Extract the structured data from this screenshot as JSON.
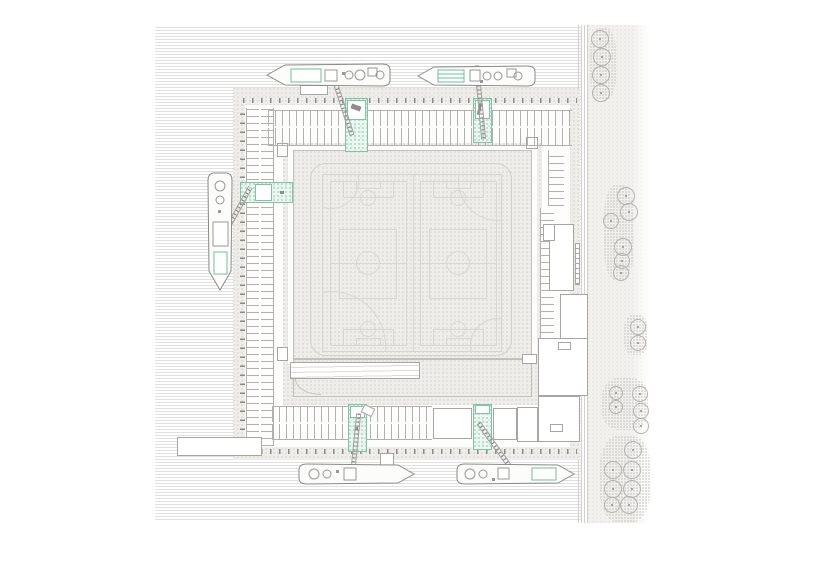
{
  "canvas": {
    "w": 818,
    "h": 578,
    "background": "#ffffff"
  },
  "colors": {
    "water_line": "#e0e0e0",
    "paving_dot": "#d7d5d1",
    "green_accent": "#7fc4a4",
    "green_fill": "#edf6f1",
    "boat_outline": "#8a8a8a",
    "building_outline": "#a8a6a2",
    "field_line": "#d9d7d3",
    "bollard": "#8c8a86"
  },
  "scene": {
    "water": {
      "x": 155,
      "y": 27,
      "w": 427,
      "h": 494
    },
    "right_strip": {
      "deck": {
        "x": 578,
        "y": 25,
        "w": 10,
        "h": 498
      },
      "ground": {
        "x": 588,
        "y": 25,
        "w": 62,
        "h": 498
      },
      "patches": [
        {
          "x": 590,
          "y": 28,
          "w": 26,
          "h": 72
        },
        {
          "x": 604,
          "y": 185,
          "w": 30,
          "h": 95
        },
        {
          "x": 624,
          "y": 315,
          "w": 24,
          "h": 40
        },
        {
          "x": 602,
          "y": 378,
          "w": 46,
          "h": 52
        },
        {
          "x": 600,
          "y": 436,
          "w": 50,
          "h": 86
        }
      ]
    },
    "trees": [
      [
        600,
        39,
        9
      ],
      [
        602,
        57,
        9
      ],
      [
        601,
        75,
        9
      ],
      [
        601,
        93,
        9
      ],
      [
        626,
        196,
        9
      ],
      [
        629,
        212,
        9
      ],
      [
        611,
        221,
        8
      ],
      [
        623,
        247,
        9
      ],
      [
        622,
        261,
        8
      ],
      [
        621,
        273,
        8
      ],
      [
        638,
        327,
        8
      ],
      [
        638,
        343,
        8
      ],
      [
        616,
        393,
        7
      ],
      [
        640,
        394,
        8
      ],
      [
        616,
        407,
        7
      ],
      [
        641,
        411,
        8
      ],
      [
        641,
        426,
        8
      ],
      [
        633,
        450,
        9
      ],
      [
        613,
        470,
        9
      ],
      [
        632,
        470,
        9
      ],
      [
        613,
        489,
        9
      ],
      [
        632,
        489,
        9
      ],
      [
        612,
        505,
        8
      ],
      [
        629,
        505,
        9
      ]
    ],
    "platform": {
      "outer": {
        "x": 233,
        "y": 88,
        "w": 347,
        "h": 372
      },
      "inner": {
        "x": 245,
        "y": 105,
        "w": 325,
        "h": 342
      }
    },
    "plaza": {
      "x": 283,
      "y": 143,
      "w": 259,
      "h": 262
    },
    "walkway": {
      "x": 288,
      "y": 146,
      "w": 249,
      "h": 218
    },
    "central_deck": {
      "x": 293,
      "y": 150,
      "w": 239,
      "h": 209
    },
    "lower_apron": {
      "x": 293,
      "y": 359,
      "w": 239,
      "h": 38
    },
    "corner_pavilions": [
      {
        "x": 277,
        "y": 143,
        "w": 11,
        "h": 14
      },
      {
        "x": 277,
        "y": 347,
        "w": 11,
        "h": 14
      },
      {
        "x": 526,
        "y": 137,
        "w": 12,
        "h": 12
      },
      {
        "x": 522,
        "y": 354,
        "w": 15,
        "h": 10
      }
    ],
    "track": {
      "x": 310,
      "y": 163,
      "w": 202,
      "h": 193
    },
    "field": {
      "box": {
        "x": 322,
        "y": 174,
        "w": 180,
        "h": 178
      },
      "rects": [
        [
          7,
          6,
          77,
          165
        ],
        [
          97,
          6,
          77,
          165
        ],
        [
          20,
          6,
          51,
          17
        ],
        [
          33,
          6,
          25,
          8
        ],
        [
          20,
          154,
          51,
          17
        ],
        [
          33,
          163,
          25,
          8
        ],
        [
          110,
          6,
          51,
          17
        ],
        [
          123,
          6,
          25,
          8
        ],
        [
          110,
          154,
          51,
          17
        ],
        [
          123,
          163,
          25,
          8
        ],
        [
          16,
          54,
          58,
          70
        ],
        [
          106,
          54,
          58,
          70
        ]
      ],
      "hlines": [
        [
          7,
          88,
          77
        ],
        [
          97,
          88,
          77
        ]
      ],
      "vlines": [
        [
          90,
          0,
          178
        ]
      ],
      "circles": [
        [
          45,
          88,
          12
        ],
        [
          135,
          88,
          12
        ],
        [
          45,
          23,
          8
        ],
        [
          135,
          23,
          8
        ],
        [
          45,
          154,
          8
        ],
        [
          135,
          154,
          8
        ],
        [
          8,
          171,
          55
        ],
        [
          175,
          6,
          40
        ],
        [
          175,
          171,
          28
        ],
        [
          8,
          6,
          28
        ]
      ]
    },
    "parking_bands": [
      {
        "x": 268,
        "y": 110,
        "w": 304,
        "h": 16,
        "dir": "h",
        "b": "t"
      },
      {
        "x": 268,
        "y": 128,
        "w": 304,
        "h": 18,
        "dir": "h",
        "b": "b"
      },
      {
        "x": 246,
        "y": 108,
        "w": 13,
        "h": 338,
        "dir": "v",
        "b": "l"
      },
      {
        "x": 261,
        "y": 108,
        "w": 13,
        "h": 338,
        "dir": "v",
        "b": "r"
      },
      {
        "x": 272,
        "y": 406,
        "w": 160,
        "h": 16,
        "dir": "h",
        "b": "t"
      },
      {
        "x": 272,
        "y": 424,
        "w": 160,
        "h": 16,
        "dir": "h",
        "b": "b"
      },
      {
        "x": 540,
        "y": 208,
        "w": 14,
        "h": 188,
        "dir": "v",
        "b": "l",
        "bg": true
      },
      {
        "x": 548,
        "y": 150,
        "w": 16,
        "h": 56,
        "dir": "v",
        "b": "l"
      }
    ],
    "bollard_rows": [
      {
        "x": 243,
        "y": 98,
        "w": 334,
        "h": 5,
        "dir": "h"
      },
      {
        "x": 240,
        "y": 106,
        "w": 5,
        "h": 342,
        "dir": "v"
      },
      {
        "x": 243,
        "y": 449,
        "w": 334,
        "h": 5,
        "dir": "h"
      }
    ],
    "green_patches": [
      {
        "x": 345,
        "y": 98,
        "w": 23,
        "h": 54
      },
      {
        "x": 473,
        "y": 98,
        "w": 19,
        "h": 45
      },
      {
        "x": 240,
        "y": 182,
        "w": 53,
        "h": 21
      },
      {
        "x": 348,
        "y": 404,
        "w": 19,
        "h": 48
      },
      {
        "x": 473,
        "y": 404,
        "w": 19,
        "h": 46
      }
    ],
    "planter_boxes": [
      {
        "x": 347,
        "y": 100,
        "w": 19,
        "h": 20,
        "g": true
      },
      {
        "x": 475,
        "y": 100,
        "w": 15,
        "h": 19,
        "g": true
      },
      {
        "x": 255,
        "y": 184,
        "w": 17,
        "h": 17,
        "g": true
      },
      {
        "x": 350,
        "y": 406,
        "w": 15,
        "h": 12,
        "g": true
      },
      {
        "x": 475,
        "y": 405,
        "w": 15,
        "h": 9,
        "g": true
      },
      {
        "x": 362,
        "y": 406,
        "w": 12,
        "h": 9,
        "rot": 25
      },
      {
        "x": 300,
        "y": 85,
        "w": 28,
        "h": 10
      },
      {
        "x": 380,
        "y": 453,
        "w": 14,
        "h": 14
      }
    ],
    "site_objects": [
      {
        "x": 351,
        "y": 105,
        "w": 10,
        "h": 5,
        "rot": 20
      },
      {
        "x": 478,
        "y": 103,
        "w": 3,
        "h": 12,
        "rot": 12
      },
      {
        "x": 280,
        "y": 191,
        "w": 4,
        "h": 3
      },
      {
        "x": 355,
        "y": 427,
        "w": 3,
        "h": 3
      }
    ],
    "buildings": [
      {
        "id": "grandstand",
        "x": 290,
        "y": 362,
        "w": 130,
        "h": 17,
        "lines": true
      },
      {
        "id": "east-hall",
        "x": 549,
        "y": 224,
        "w": 25,
        "h": 67
      },
      {
        "id": "east-hall-annex",
        "x": 543,
        "y": 224,
        "w": 12,
        "h": 17
      },
      {
        "id": "east-hall-stairs",
        "x": 575,
        "y": 243,
        "w": 5,
        "h": 42,
        "ladder": true
      },
      {
        "id": "east-pavilion",
        "x": 560,
        "y": 294,
        "w": 28,
        "h": 47
      },
      {
        "id": "service-block-a",
        "x": 538,
        "y": 338,
        "w": 50,
        "h": 58
      },
      {
        "id": "service-block-a-core",
        "x": 558,
        "y": 342,
        "w": 13,
        "h": 8
      },
      {
        "id": "service-block-b",
        "x": 538,
        "y": 396,
        "w": 42,
        "h": 46
      },
      {
        "id": "service-block-b-core",
        "x": 550,
        "y": 424,
        "w": 13,
        "h": 8
      },
      {
        "id": "south-shed-1",
        "x": 433,
        "y": 408,
        "w": 39,
        "h": 31
      },
      {
        "id": "south-shed-2",
        "x": 493,
        "y": 408,
        "w": 24,
        "h": 32
      },
      {
        "id": "south-shed-3",
        "x": 517,
        "y": 407,
        "w": 21,
        "h": 35
      },
      {
        "id": "west-pier",
        "x": 177,
        "y": 437,
        "w": 85,
        "h": 19
      }
    ],
    "arc_decos": [
      {
        "x": 295,
        "y": 379,
        "w": 26,
        "h": 16
      }
    ],
    "gangways": [
      {
        "x1": 331,
        "y1": 70,
        "x2": 352,
        "y2": 136
      },
      {
        "x1": 477,
        "y1": 66,
        "x2": 484,
        "y2": 140
      },
      {
        "x1": 221,
        "y1": 240,
        "x2": 250,
        "y2": 188
      },
      {
        "x1": 359,
        "y1": 414,
        "x2": 352,
        "y2": 484
      },
      {
        "x1": 479,
        "y1": 424,
        "x2": 520,
        "y2": 481
      }
    ],
    "boats": [
      {
        "x": 265,
        "y": 62,
        "w": 128,
        "h": 26,
        "bow": "left",
        "details": [
          {
            "t": "g",
            "x": 26,
            "y": 7,
            "w": 30,
            "h": 13
          },
          {
            "t": "r",
            "x": 60,
            "y": 8,
            "w": 12,
            "h": 11
          },
          {
            "t": "c",
            "x": 84,
            "y": 13,
            "r": 4
          },
          {
            "t": "c",
            "x": 95,
            "y": 13,
            "r": 5
          },
          {
            "t": "r",
            "x": 103,
            "y": 6,
            "w": 9,
            "h": 8
          },
          {
            "t": "c",
            "x": 115,
            "y": 13,
            "r": 4
          },
          {
            "t": "d",
            "x": 77,
            "y": 10,
            "w": 3,
            "h": 3
          }
        ]
      },
      {
        "x": 416,
        "y": 64,
        "w": 122,
        "h": 24,
        "bow": "left",
        "details": [
          {
            "t": "gs",
            "x": 22,
            "y": 6,
            "w": 26,
            "h": 12
          },
          {
            "t": "r",
            "x": 54,
            "y": 6,
            "w": 10,
            "h": 11
          },
          {
            "t": "c",
            "x": 71,
            "y": 12,
            "r": 4
          },
          {
            "t": "c",
            "x": 82,
            "y": 12,
            "r": 4
          },
          {
            "t": "r",
            "x": 91,
            "y": 5,
            "w": 9,
            "h": 8
          },
          {
            "t": "c",
            "x": 102,
            "y": 12,
            "r": 4
          },
          {
            "t": "d",
            "x": 64,
            "y": 16,
            "w": 3,
            "h": 3
          }
        ]
      },
      {
        "x": 206,
        "y": 170,
        "w": 28,
        "h": 122,
        "bow": "down",
        "details": [
          {
            "t": "c",
            "x": 14,
            "y": 16,
            "r": 5
          },
          {
            "t": "c",
            "x": 14,
            "y": 30,
            "r": 4
          },
          {
            "t": "d",
            "x": 12,
            "y": 40,
            "w": 3,
            "h": 3
          },
          {
            "t": "r",
            "x": 7,
            "y": 52,
            "w": 15,
            "h": 24
          },
          {
            "t": "g",
            "x": 8,
            "y": 82,
            "w": 13,
            "h": 22
          }
        ]
      },
      {
        "x": 296,
        "y": 462,
        "w": 120,
        "h": 24,
        "bow": "right",
        "details": [
          {
            "t": "c",
            "x": 18,
            "y": 12,
            "r": 5
          },
          {
            "t": "c",
            "x": 31,
            "y": 12,
            "r": 4
          },
          {
            "t": "d",
            "x": 40,
            "y": 8,
            "w": 3,
            "h": 3
          },
          {
            "t": "r",
            "x": 48,
            "y": 6,
            "w": 12,
            "h": 12
          }
        ]
      },
      {
        "x": 454,
        "y": 462,
        "w": 122,
        "h": 24,
        "bow": "right",
        "details": [
          {
            "t": "c",
            "x": 16,
            "y": 12,
            "r": 5
          },
          {
            "t": "c",
            "x": 29,
            "y": 12,
            "r": 4
          },
          {
            "t": "d",
            "x": 38,
            "y": 16,
            "w": 3,
            "h": 3
          },
          {
            "t": "r",
            "x": 44,
            "y": 6,
            "w": 11,
            "h": 11
          },
          {
            "t": "g",
            "x": 78,
            "y": 6,
            "w": 24,
            "h": 12
          }
        ]
      }
    ]
  }
}
